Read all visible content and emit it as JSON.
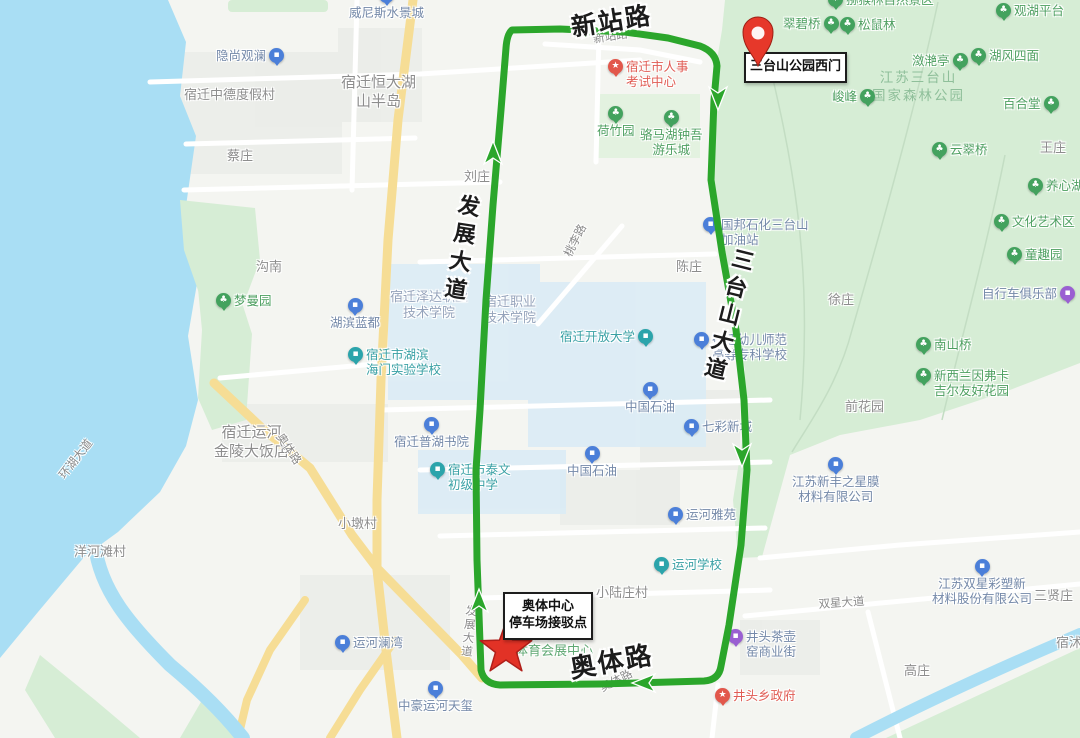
{
  "map": {
    "colors": {
      "route_green": "#2ba62b",
      "marker_red": "#e23226",
      "park_green": "#d6edd5",
      "water_blue": "#a9def4",
      "road_yellow": "#f6dd95"
    },
    "markers": {
      "pin_label": "三台山公园西门",
      "star_label": [
        "奥体中心",
        "停车场接驳点"
      ]
    },
    "watermark": [
      "江苏三台山",
      "国家森林公园"
    ],
    "big_roads": [
      {
        "text": "新站路"
      },
      {
        "text": "发展大道"
      },
      {
        "text": "三台山大道"
      },
      {
        "text": "奥体路"
      }
    ],
    "roads": [
      {
        "t": "新站路",
        "x": 592,
        "y": 31,
        "r": -9
      },
      {
        "t": "桃李路",
        "x": 560,
        "y": 252,
        "r": -63
      },
      {
        "t": "奥体路",
        "x": 286,
        "y": 430,
        "r": 56
      },
      {
        "t": "环湖大道",
        "x": 55,
        "y": 472,
        "r": -52
      },
      {
        "t": "发展大道",
        "x": 464,
        "y": 604,
        "r": 6,
        "v": 1
      },
      {
        "t": "双星大道",
        "x": 818,
        "y": 596,
        "r": -4
      },
      {
        "t": "奥体路",
        "x": 597,
        "y": 681,
        "r": -27
      }
    ],
    "pois": [
      {
        "t": "猕猴林自然景区",
        "x": 828,
        "y": -8,
        "c": "park",
        "ip": "l"
      },
      {
        "t": "翠碧桥",
        "x": 783,
        "y": 16,
        "c": "park",
        "ip": "r"
      },
      {
        "t": "松鼠林",
        "x": 840,
        "y": 17,
        "c": "park",
        "ip": "l"
      },
      {
        "t": "观湖平台",
        "x": 996,
        "y": 3,
        "c": "park",
        "ip": "l"
      },
      {
        "t": "潋滟亭",
        "x": 912,
        "y": 53,
        "c": "park",
        "ip": "r"
      },
      {
        "t": "湖风四面",
        "x": 971,
        "y": 48,
        "c": "park",
        "ip": "l"
      },
      {
        "t": "峻峰",
        "x": 832,
        "y": 89,
        "c": "park",
        "ip": "r"
      },
      {
        "t": "百合堂",
        "x": 1003,
        "y": 96,
        "c": "park",
        "ip": "r"
      },
      {
        "t": "云翠桥",
        "x": 932,
        "y": 142,
        "c": "park",
        "ip": "l"
      },
      {
        "t": "养心湖",
        "x": 1028,
        "y": 178,
        "c": "park",
        "ip": "l"
      },
      {
        "t": "文化艺术区",
        "x": 994,
        "y": 214,
        "c": "park",
        "ip": "l"
      },
      {
        "t": "童趣园",
        "x": 1007,
        "y": 247,
        "c": "park",
        "ip": "l"
      },
      {
        "t": "自行车俱乐部",
        "x": 982,
        "y": 286,
        "c": "purple",
        "ip": "r"
      },
      {
        "t": "南山桥",
        "x": 916,
        "y": 337,
        "c": "park",
        "ip": "l"
      },
      {
        "t": [
          "新西兰因弗卡",
          "吉尔友好花园"
        ],
        "x": 916,
        "y": 368,
        "c": "park",
        "ip": "l"
      },
      {
        "t": "荷竹园",
        "x": 597,
        "y": 106,
        "c": "park",
        "ip": "t"
      },
      {
        "t": [
          "骆马湖钟吾",
          "游乐城"
        ],
        "x": 640,
        "y": 110,
        "c": "park",
        "ip": "t"
      },
      {
        "t": "梦曼园",
        "x": 216,
        "y": 293,
        "c": "park",
        "ip": "l"
      },
      {
        "t": "威尼斯水景城",
        "x": 349,
        "y": -12,
        "c": "blue",
        "ip": "t"
      },
      {
        "t": "隐尚观澜",
        "x": 216,
        "y": 48,
        "c": "blue",
        "ip": "r"
      },
      {
        "t": "湖滨蓝都",
        "x": 330,
        "y": 298,
        "c": "blue",
        "ip": "t"
      },
      {
        "t": [
          "宿迁市人事",
          "考试中心"
        ],
        "x": 608,
        "y": 59,
        "c": "red",
        "ip": "l"
      },
      {
        "t": [
          "国邦石化三台山",
          "加油站"
        ],
        "x": 703,
        "y": 217,
        "c": "blue",
        "ip": "l"
      },
      {
        "t": [
          "宿迁幼儿师范",
          "高等专科学校"
        ],
        "x": 694,
        "y": 332,
        "c": "blue",
        "ip": "l"
      },
      {
        "t": "中国石油",
        "x": 625,
        "y": 382,
        "c": "blue",
        "ip": "t"
      },
      {
        "t": "七彩新城",
        "x": 684,
        "y": 419,
        "c": "blue",
        "ip": "l"
      },
      {
        "t": "中国石油",
        "x": 567,
        "y": 446,
        "c": "blue",
        "ip": "t"
      },
      {
        "t": "运河雅苑",
        "x": 668,
        "y": 507,
        "c": "blue",
        "ip": "l"
      },
      {
        "t": "运河学校",
        "x": 654,
        "y": 557,
        "c": "teal",
        "ip": "l"
      },
      {
        "t": "宿迁普湖书院",
        "x": 394,
        "y": 417,
        "c": "blue",
        "ip": "t"
      },
      {
        "t": [
          "宿迁市泰文",
          "初级中学"
        ],
        "x": 430,
        "y": 462,
        "c": "teal",
        "ip": "l"
      },
      {
        "t": [
          "宿迁市湖滨",
          "海门实验学校"
        ],
        "x": 348,
        "y": 347,
        "c": "teal",
        "ip": "l"
      },
      {
        "t": "宿迁开放大学",
        "x": 560,
        "y": 329,
        "c": "teal",
        "ip": "r"
      },
      {
        "t": "运河澜湾",
        "x": 335,
        "y": 635,
        "c": "blue",
        "ip": "l"
      },
      {
        "t": "中豪运河天玺",
        "x": 398,
        "y": 681,
        "c": "blue",
        "ip": "t"
      },
      {
        "t": [
          "江苏新丰之星膜",
          "材料有限公司"
        ],
        "x": 792,
        "y": 457,
        "c": "blue",
        "ip": "t"
      },
      {
        "t": [
          "江苏双星彩塑新",
          "材料股份有限公司"
        ],
        "x": 932,
        "y": 559,
        "c": "blue",
        "ip": "t"
      },
      {
        "t": [
          "井头茶壶",
          "窑商业街"
        ],
        "x": 728,
        "y": 629,
        "c": "purple",
        "ip": "l"
      },
      {
        "t": "井头乡政府",
        "x": 715,
        "y": 688,
        "c": "red",
        "ip": "l"
      }
    ],
    "areas": [
      {
        "t": "宿迁中德度假村",
        "x": 184,
        "y": 88
      },
      {
        "t": [
          "宿迁恒大湖",
          "山半岛"
        ],
        "x": 341,
        "y": 73,
        "big": 1
      },
      {
        "t": "蔡庄",
        "x": 227,
        "y": 149
      },
      {
        "t": "刘庄",
        "x": 464,
        "y": 170
      },
      {
        "t": "沟南",
        "x": 256,
        "y": 260
      },
      {
        "t": "陈庄",
        "x": 676,
        "y": 260
      },
      {
        "t": "徐庄",
        "x": 828,
        "y": 293
      },
      {
        "t": "前花园",
        "x": 845,
        "y": 400
      },
      {
        "t": "王庄",
        "x": 1040,
        "y": 141
      },
      {
        "t": "小墩村",
        "x": 338,
        "y": 517
      },
      {
        "t": "洋河滩村",
        "x": 74,
        "y": 545
      },
      {
        "t": "小陆庄村",
        "x": 596,
        "y": 586
      },
      {
        "t": "高庄",
        "x": 904,
        "y": 664
      },
      {
        "t": "三贤庄",
        "x": 1034,
        "y": 589
      },
      {
        "t": [
          "宿迁运河",
          "金陵大饭店"
        ],
        "x": 214,
        "y": 423,
        "big": 1
      },
      {
        "t": [
          "宿迁泽达职业",
          "技术学院"
        ],
        "x": 390,
        "y": 290,
        "c": "campus"
      },
      {
        "t": [
          "宿迁职业",
          "技术学院"
        ],
        "x": 484,
        "y": 295,
        "c": "campus"
      },
      {
        "t": "宿沭河",
        "x": 1056,
        "y": 636
      },
      {
        "t": [
          "宿迁市国际",
          "体育会展中心"
        ],
        "x": 515,
        "y": 628,
        "c": "green"
      }
    ]
  }
}
